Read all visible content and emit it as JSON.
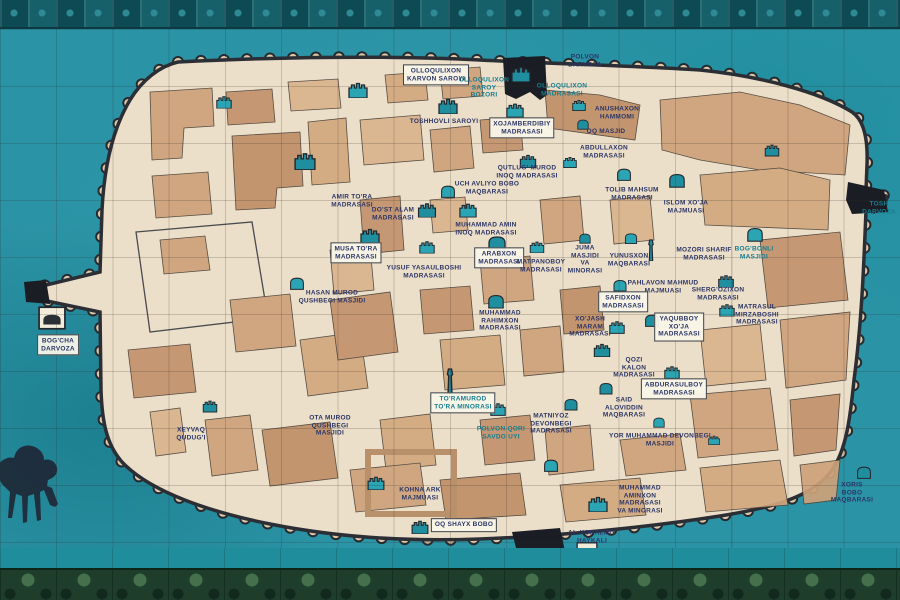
{
  "mural": {
    "description": "ceramic tile city map mural",
    "colors": {
      "field_teal": "#2a93a5",
      "map_cream": "#ecdfc9",
      "building_tan": "#cda27a",
      "landmark_teal": "#2ba4b4",
      "ink_text": "#2b3566",
      "teal_text": "#157d90",
      "border_top": "#12505a",
      "border_bottom": "#1e3d2a"
    },
    "labels": [
      {
        "t": "OLLOQULIXON\nKARVON SAROYI",
        "x": 436,
        "y": 75,
        "box": true
      },
      {
        "t": "OLLOQULIXON\nSAROY\nBOZORI",
        "x": 484,
        "y": 88,
        "s": "teal"
      },
      {
        "t": "POLVON\nDARVOZA",
        "x": 585,
        "y": 61
      },
      {
        "t": "OLLOQULIXON\nMADRASASI",
        "x": 562,
        "y": 90,
        "s": "teal"
      },
      {
        "t": "TOSHHOVLI SAROYI",
        "x": 444,
        "y": 122
      },
      {
        "t": "XOJAMBERDIBIY\nMADRASASI",
        "x": 522,
        "y": 128,
        "box": true
      },
      {
        "t": "ANUSHAXON\nHAMMOMI",
        "x": 617,
        "y": 113
      },
      {
        "t": "OQ MASJID",
        "x": 606,
        "y": 132
      },
      {
        "t": "ABDULLAXON\nMADRASASI",
        "x": 604,
        "y": 152
      },
      {
        "t": "QUTLUG' MUROD\nINOQ MADRASASI",
        "x": 527,
        "y": 172
      },
      {
        "t": "UCH AVLIYO BOBO\nMAQBARASI",
        "x": 487,
        "y": 188
      },
      {
        "t": "AMIR TO'RA\nMADRASASI",
        "x": 352,
        "y": 201
      },
      {
        "t": "DO'ST ALAM\nMADRASASI",
        "x": 393,
        "y": 214
      },
      {
        "t": "MUHAMMAD AMIN\nINOQ MADRASASI",
        "x": 486,
        "y": 229
      },
      {
        "t": "MUSA TO'RA\nMADRASASI",
        "x": 356,
        "y": 253,
        "box": true
      },
      {
        "t": "ARABXON\nMADRASASI",
        "x": 499,
        "y": 258,
        "box": true
      },
      {
        "t": "MATPANOBOY\nMADRASASI",
        "x": 541,
        "y": 266
      },
      {
        "t": "JUMA\nMASJIDI\nVA\nMINORASI",
        "x": 585,
        "y": 260
      },
      {
        "t": "YUSUF YASAULBOSHI\nMADRASASI",
        "x": 424,
        "y": 272
      },
      {
        "t": "HASAN MUROD\nQUSHBEGI MASJIDI",
        "x": 332,
        "y": 297
      },
      {
        "t": "MUHAMMAD\nRAHIMXON\nMADRASASI",
        "x": 500,
        "y": 321
      },
      {
        "t": "TOLIB MAHSUM\nMADRASASI",
        "x": 632,
        "y": 194
      },
      {
        "t": "ISLOM XO'JA\nMAJMUASI",
        "x": 686,
        "y": 207
      },
      {
        "t": "MOZORI SHARIF\nMADRASASI",
        "x": 704,
        "y": 254
      },
      {
        "t": "YUNUSXON\nMAQBARASI",
        "x": 629,
        "y": 260
      },
      {
        "t": "BOG'BONLI\nMASJIDI",
        "x": 754,
        "y": 253,
        "s": "teal"
      },
      {
        "t": "PAHLAVON MAHMUD\nMAJMUASI",
        "x": 663,
        "y": 287
      },
      {
        "t": "SHERG'OZIXON\nMADRASASI",
        "x": 718,
        "y": 294
      },
      {
        "t": "SAFIDXON\nMADRASASI",
        "x": 623,
        "y": 302,
        "box": true
      },
      {
        "t": "MATRASUL\nMIRZABOSHI\nMADRASASI",
        "x": 757,
        "y": 315
      },
      {
        "t": "YAQUBBOY\nXO'JA\nMADRASASI",
        "x": 679,
        "y": 327,
        "box": true
      },
      {
        "t": "XO'JASH\nMARAM\nMADRASASI",
        "x": 590,
        "y": 327
      },
      {
        "t": "QOZI\nKALON\nMADRASASI",
        "x": 634,
        "y": 368
      },
      {
        "t": "ABDURASULBOY\nMADRASASI",
        "x": 674,
        "y": 389,
        "box": true
      },
      {
        "t": "SAID\nALOVIDDIN\nMAQBARASI",
        "x": 624,
        "y": 408
      },
      {
        "t": "YOR MUHAMMAD DEVONBEGI\nMASJIDI",
        "x": 660,
        "y": 440
      },
      {
        "t": "TO'RAMUROD\nTO'RA MINORASI",
        "x": 463,
        "y": 403,
        "box": true,
        "s": "teal"
      },
      {
        "t": "POLVON QORI\nSAVDO UYI",
        "x": 501,
        "y": 433,
        "s": "teal"
      },
      {
        "t": "MATNIYOZ\nDEVONBEGI\nMADRASASI",
        "x": 551,
        "y": 424
      },
      {
        "t": "OTA MUROD\nQUSHBEGI\nMASJIDI",
        "x": 330,
        "y": 426
      },
      {
        "t": "XEYVAQ\nQUDUG'I",
        "x": 191,
        "y": 434
      },
      {
        "t": "KOHNA ARK\nMAJMUASI",
        "x": 420,
        "y": 494
      },
      {
        "t": "OQ SHAYX BOBO",
        "x": 464,
        "y": 525,
        "box": true
      },
      {
        "t": "MUHAMMAD\nAMINXON\nMADRASASI\nVA MINORASI",
        "x": 640,
        "y": 500
      },
      {
        "t": "AL-XORAZMIY\nHAYKALI",
        "x": 592,
        "y": 537
      },
      {
        "t": "OTA\nDARVOZA",
        "x": 512,
        "y": 557
      },
      {
        "t": "BOG'CHA\nDARVOZA",
        "x": 58,
        "y": 345,
        "box": true
      },
      {
        "t": "TOSH\nDARVOZA",
        "x": 879,
        "y": 208,
        "s": "teal"
      },
      {
        "t": "XORIS\nBOBO\nMAQBARASI",
        "x": 852,
        "y": 493
      }
    ],
    "landmarks": [
      {
        "x": 224,
        "y": 102,
        "w": 16,
        "h": 13,
        "t": "fort"
      },
      {
        "x": 305,
        "y": 161,
        "w": 22,
        "h": 18,
        "t": "fort"
      },
      {
        "x": 358,
        "y": 90,
        "w": 22,
        "h": 16,
        "t": "fort"
      },
      {
        "x": 448,
        "y": 106,
        "w": 20,
        "h": 16,
        "t": "fort"
      },
      {
        "x": 515,
        "y": 110,
        "w": 18,
        "h": 15,
        "t": "fort"
      },
      {
        "x": 521,
        "y": 74,
        "w": 20,
        "h": 16,
        "t": "fort"
      },
      {
        "x": 579,
        "y": 105,
        "w": 14,
        "h": 13,
        "t": "fort"
      },
      {
        "x": 583,
        "y": 124,
        "w": 13,
        "h": 12,
        "t": "arch"
      },
      {
        "x": 570,
        "y": 162,
        "w": 14,
        "h": 12,
        "t": "fort"
      },
      {
        "x": 528,
        "y": 161,
        "w": 17,
        "h": 14,
        "t": "fort"
      },
      {
        "x": 448,
        "y": 191,
        "w": 16,
        "h": 15,
        "t": "arch"
      },
      {
        "x": 427,
        "y": 210,
        "w": 20,
        "h": 15,
        "t": "fort"
      },
      {
        "x": 468,
        "y": 210,
        "w": 18,
        "h": 15,
        "t": "fort"
      },
      {
        "x": 370,
        "y": 236,
        "w": 20,
        "h": 16,
        "t": "fort"
      },
      {
        "x": 427,
        "y": 247,
        "w": 16,
        "h": 13,
        "t": "fort"
      },
      {
        "x": 497,
        "y": 243,
        "w": 20,
        "h": 16,
        "t": "arch"
      },
      {
        "x": 537,
        "y": 247,
        "w": 15,
        "h": 12,
        "t": "fort"
      },
      {
        "x": 585,
        "y": 238,
        "w": 13,
        "h": 24,
        "t": "arch"
      },
      {
        "x": 624,
        "y": 174,
        "w": 16,
        "h": 15,
        "t": "arch"
      },
      {
        "x": 677,
        "y": 180,
        "w": 18,
        "h": 16,
        "t": "arch"
      },
      {
        "x": 631,
        "y": 238,
        "w": 14,
        "h": 13,
        "t": "arch"
      },
      {
        "x": 651,
        "y": 250,
        "w": 10,
        "h": 22,
        "t": "minaret"
      },
      {
        "x": 755,
        "y": 234,
        "w": 18,
        "h": 16,
        "t": "arch"
      },
      {
        "x": 772,
        "y": 150,
        "w": 15,
        "h": 13,
        "t": "fort"
      },
      {
        "x": 620,
        "y": 285,
        "w": 15,
        "h": 14,
        "t": "arch"
      },
      {
        "x": 726,
        "y": 281,
        "w": 18,
        "h": 13,
        "t": "fort"
      },
      {
        "x": 727,
        "y": 310,
        "w": 16,
        "h": 13,
        "t": "fort"
      },
      {
        "x": 652,
        "y": 320,
        "w": 16,
        "h": 14,
        "t": "arch"
      },
      {
        "x": 617,
        "y": 327,
        "w": 16,
        "h": 14,
        "t": "fort"
      },
      {
        "x": 496,
        "y": 301,
        "w": 18,
        "h": 15,
        "t": "arch"
      },
      {
        "x": 297,
        "y": 283,
        "w": 16,
        "h": 14,
        "t": "arch"
      },
      {
        "x": 602,
        "y": 350,
        "w": 17,
        "h": 14,
        "t": "fort"
      },
      {
        "x": 672,
        "y": 372,
        "w": 16,
        "h": 14,
        "t": "fort"
      },
      {
        "x": 606,
        "y": 388,
        "w": 15,
        "h": 14,
        "t": "arch"
      },
      {
        "x": 659,
        "y": 422,
        "w": 13,
        "h": 12,
        "t": "arch"
      },
      {
        "x": 450,
        "y": 381,
        "w": 9,
        "h": 26,
        "t": "minaret"
      },
      {
        "x": 498,
        "y": 409,
        "w": 16,
        "h": 14,
        "t": "fort"
      },
      {
        "x": 571,
        "y": 404,
        "w": 15,
        "h": 13,
        "t": "arch"
      },
      {
        "x": 551,
        "y": 465,
        "w": 16,
        "h": 15,
        "t": "arch"
      },
      {
        "x": 210,
        "y": 406,
        "w": 15,
        "h": 13,
        "t": "fort"
      },
      {
        "x": 376,
        "y": 483,
        "w": 22,
        "h": 14,
        "t": "fort"
      },
      {
        "x": 420,
        "y": 527,
        "w": 24,
        "h": 14,
        "t": "fort"
      },
      {
        "x": 598,
        "y": 504,
        "w": 20,
        "h": 16,
        "t": "fort"
      },
      {
        "x": 864,
        "y": 472,
        "w": 16,
        "h": 14,
        "t": "arch"
      },
      {
        "x": 714,
        "y": 440,
        "w": 12,
        "h": 10,
        "t": "fort"
      },
      {
        "x": 587,
        "y": 551,
        "w": 24,
        "h": 18,
        "t": "plaque"
      },
      {
        "x": 52,
        "y": 318,
        "w": 28,
        "h": 24,
        "t": "plaque"
      }
    ]
  }
}
